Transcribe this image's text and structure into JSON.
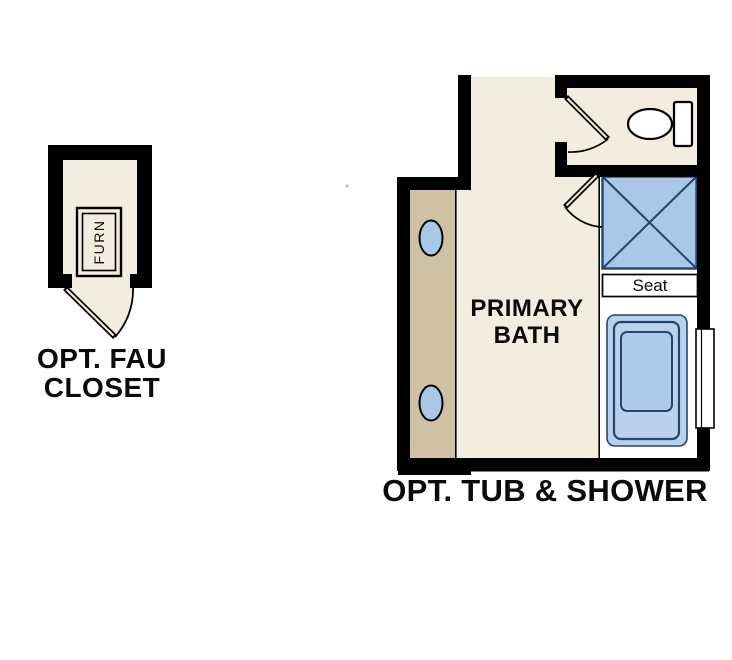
{
  "labels": {
    "fau_closet_line1": "OPT. FAU",
    "fau_closet_line2": "CLOSET",
    "furnace": "FURN",
    "primary_bath_line1": "PRIMARY",
    "primary_bath_line2": "BATH",
    "seat": "Seat",
    "tub_shower": "OPT. TUB & SHOWER"
  },
  "colors": {
    "background": "#ffffff",
    "wall": "#000000",
    "floor": "#f2edde",
    "vanity": "#cfc2a4",
    "fixture_blue": "#a9c8e8",
    "tub_blue": "#bad1ec",
    "tub_inner_blue": "#aecbe9",
    "navy_line": "#23456b",
    "alcove": "#ffffff",
    "text": "#0a0a0a"
  }
}
